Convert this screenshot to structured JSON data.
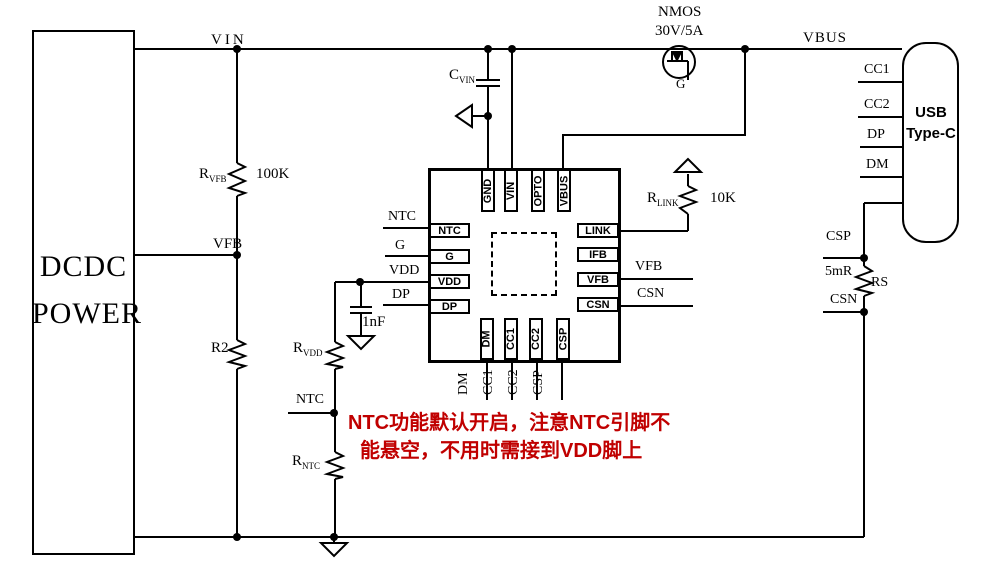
{
  "colors": {
    "wire": "#000000",
    "background": "#ffffff",
    "annotation": "#c00000"
  },
  "blocks": {
    "dcdc": {
      "line1": "DCDC",
      "line2": "POWER"
    },
    "usb": {
      "line1": "USB",
      "line2": "Type-C"
    }
  },
  "ic": {
    "pins": {
      "top": [
        "GND",
        "VIN",
        "OPTO",
        "VBUS"
      ],
      "left": [
        "NTC",
        "G",
        "VDD",
        "DP"
      ],
      "right": [
        "LINK",
        "IFB",
        "VFB",
        "CSN"
      ],
      "bottom": [
        "DM",
        "CC1",
        "CC2",
        "CSP"
      ]
    }
  },
  "nets": {
    "vin": "VIN",
    "vfb": "VFB",
    "vbus": "VBUS",
    "ntc": "NTC",
    "g": "G",
    "vdd": "VDD",
    "dp": "DP",
    "vfb_out": "VFB",
    "csn_out": "CSN",
    "dm": "DM",
    "cc1": "CC1",
    "cc2": "CC2",
    "csp": "CSP",
    "usb_cc1": "CC1",
    "usb_cc2": "CC2",
    "usb_dp": "DP",
    "usb_dm": "DM",
    "csp_sense": "CSP",
    "csn_sense": "CSN",
    "ntc_bottom": "NTC",
    "nmos_gate": "G"
  },
  "components": {
    "r_vfb": {
      "ref": "R",
      "sub": "VFB",
      "value": "100K"
    },
    "r2": {
      "ref": "R2"
    },
    "c_vin": {
      "ref": "C",
      "sub": "VIN"
    },
    "nmos": {
      "type": "NMOS",
      "rating": "30V/5A"
    },
    "r_link": {
      "ref": "R",
      "sub": "LINK",
      "value": "10K"
    },
    "c_vdd": {
      "value": "1nF"
    },
    "r_vdd": {
      "ref": "R",
      "sub": "VDD"
    },
    "r_ntc": {
      "ref": "R",
      "sub": "NTC"
    },
    "rs": {
      "ref": "RS",
      "value": "5mR"
    }
  },
  "annotation": {
    "line1": "NTC功能默认开启，注意NTC引脚不",
    "line2": "能悬空，不用时需接到VDD脚上"
  }
}
